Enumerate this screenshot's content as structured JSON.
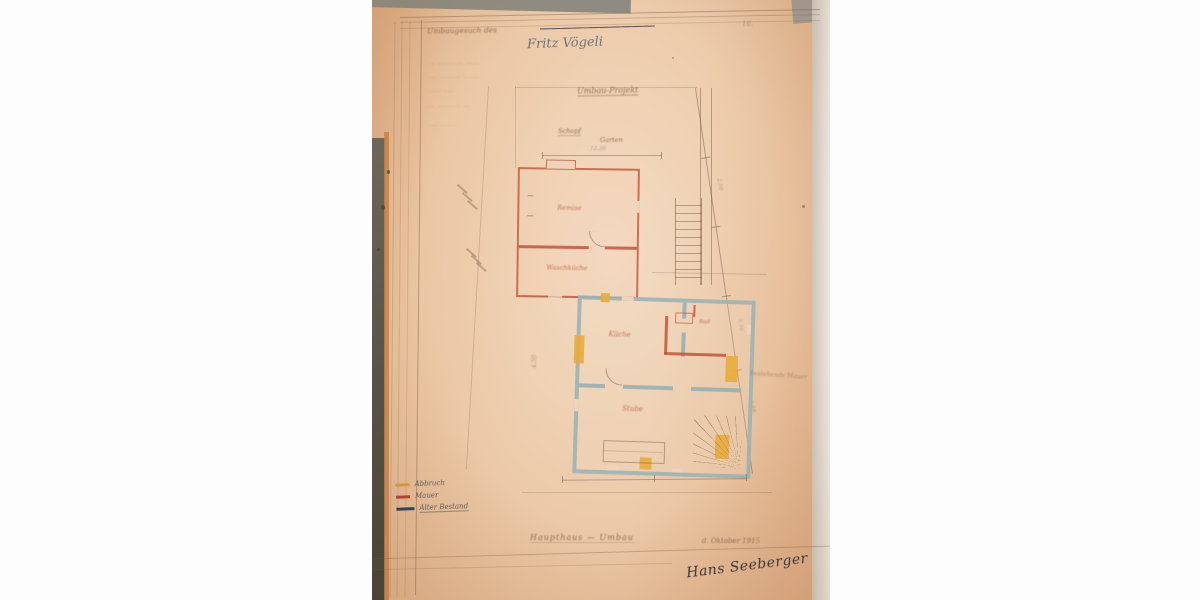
{
  "photo": {
    "caption": "Fotografie eines alten handgezeichneten Bauplans auf vergilbtem Papier",
    "header": {
      "request_line": "Umbaugesuch des",
      "struck_text": "————  ——————",
      "owner_name": "Fritz Vögeli",
      "page_mark": "18."
    },
    "faded_lines": [
      "·· ········ ····",
      "··· ······ ·····",
      "···· ···",
      "·· ······· ··",
      "··· ·····"
    ],
    "plan": {
      "title": "Umbau-Projekt",
      "label_shed": "Schopf",
      "label_garden": "Garten",
      "upper_rooms": [
        "Remise",
        "Waschküche"
      ],
      "lower_rooms": {
        "kitchen": "Küche",
        "bath": "Bad",
        "parlor": "Stube"
      },
      "wall_note": "bestehende Mauer",
      "dims": [
        "4.50",
        "2.10",
        "5.16",
        "3.48",
        "12.30"
      ]
    },
    "legend": {
      "items": [
        {
          "label": "Abbruch",
          "color": "#d79b3f"
        },
        {
          "label": "Mauer",
          "color": "#b6412e"
        },
        {
          "label": "Alter Bestand",
          "color": "#2f3d55"
        }
      ]
    },
    "footer": {
      "note": "Haupthaus — Umbau",
      "date": "d. Oktober 1915",
      "signature": "Hans Seeberger"
    }
  }
}
